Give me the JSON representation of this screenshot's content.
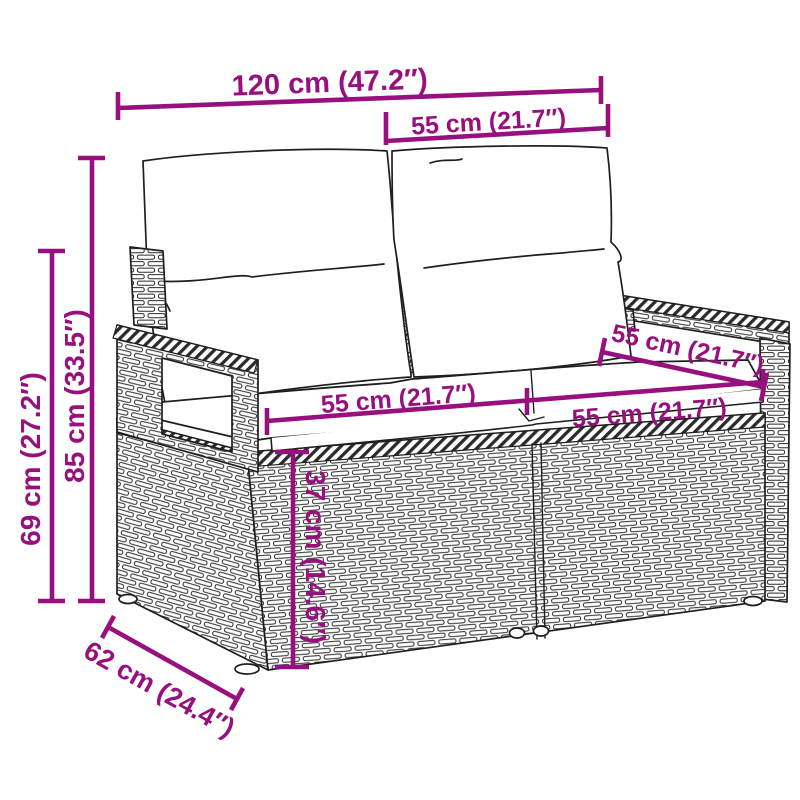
{
  "diagram": {
    "type": "product-dimension-diagram",
    "subject": "poly rattan 2-seater garden sofa line drawing with back and seat cushions",
    "colors": {
      "dimension_accent": "#97107E",
      "line_art": "#1F1F1F",
      "background": "#FFFFFF"
    },
    "dimensions": {
      "overall_width": {
        "label": "120 cm (47.2″)",
        "cm": 120,
        "inch": 47.2
      },
      "section_width_top": {
        "label": "55 cm (21.7″)",
        "cm": 55,
        "inch": 21.7
      },
      "total_height": {
        "label": "85 cm (33.5″)",
        "cm": 85,
        "inch": 33.5
      },
      "armrest_height": {
        "label": "69 cm (27.2″)",
        "cm": 69,
        "inch": 27.2
      },
      "seat_depth": {
        "label": "55 cm (21.7″)",
        "cm": 55,
        "inch": 21.7
      },
      "seat_width_left": {
        "label": "55 cm (21.7″)",
        "cm": 55,
        "inch": 21.7
      },
      "seat_width_right": {
        "label": "55 cm (21.7″)",
        "cm": 55,
        "inch": 21.7
      },
      "seat_height": {
        "label": "37 cm (14.6″)",
        "cm": 37,
        "inch": 14.6
      },
      "base_depth": {
        "label": "62 cm (24.4″)",
        "cm": 62,
        "inch": 24.4
      }
    }
  }
}
